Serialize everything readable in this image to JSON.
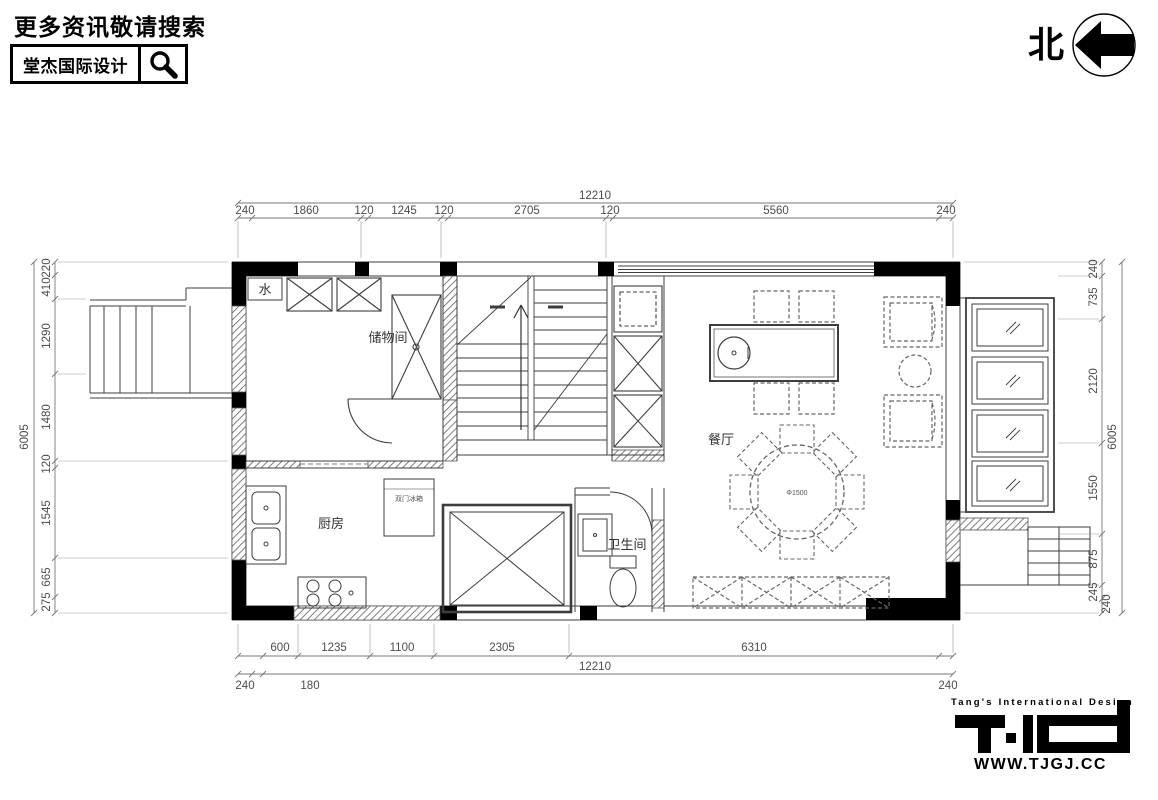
{
  "header": {
    "tagline": "更多资讯敬请搜索",
    "brand": "堂杰国际设计"
  },
  "north": {
    "label": "北"
  },
  "plan": {
    "labels": {
      "water": "水",
      "storage": "储物间",
      "kitchen": "厨房",
      "fridge": "双门冰箱",
      "bathroom": "卫生间",
      "dining": "餐厅",
      "table_note": "Φ1500"
    }
  },
  "dims": {
    "top": {
      "overall": "12210",
      "segments": [
        "240",
        "1860",
        "120",
        "1245",
        "120",
        "2705",
        "120",
        "5560",
        "240"
      ]
    },
    "bottom": {
      "overall": "12210",
      "row1": [
        "600",
        "1235",
        "1100",
        "2305",
        "6310"
      ],
      "row2": [
        "240",
        "180",
        "240"
      ]
    },
    "left": {
      "overall": "6005",
      "segments": [
        "220",
        "410",
        "1290",
        "1480",
        "120",
        "1545",
        "665",
        "275"
      ]
    },
    "right": {
      "overall": "6005",
      "segments": [
        "240",
        "735",
        "2120",
        "1550",
        "875",
        "245",
        "240"
      ]
    }
  },
  "footer": {
    "brand_en": "Tang's International Design",
    "website": "WWW.TJGJ.CC"
  }
}
